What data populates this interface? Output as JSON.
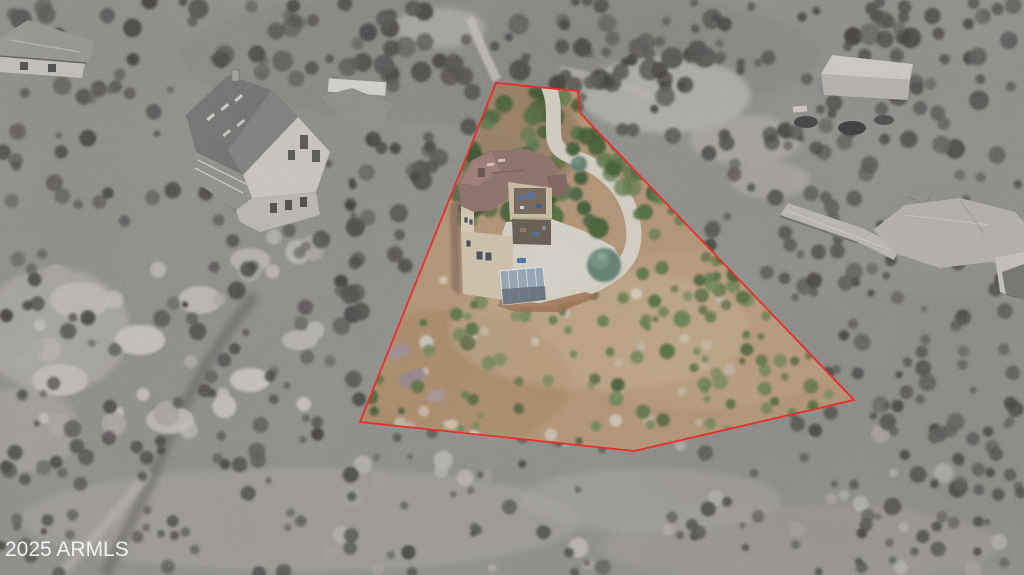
{
  "watermark": {
    "text": "2025 ARMLS"
  },
  "boundary": {
    "points": "496,83 578,91 580,113 854,400 634,451 360,422",
    "color": "#f01b15",
    "width": 2
  },
  "palette": {
    "gray_base": "#8d8b88",
    "lot_ground": "#b29170",
    "driveway": "#d6d1c6",
    "roof_main": "#8a6a64",
    "wall": "#cfc1a8",
    "spruce": "#5a7a6c",
    "tree_green": "#4a6737"
  },
  "seed": 20250101,
  "scatter": [
    {
      "target": "g-rocks",
      "x": 25,
      "y": 235,
      "w": 300,
      "h": 195,
      "count": 26,
      "rmin": 5,
      "rmax": 13,
      "colors": [
        "#b4b1ac",
        "#c1beb8",
        "#a8a5a0"
      ]
    },
    {
      "target": "g-rocks",
      "x": 300,
      "y": 430,
      "w": 724,
      "h": 140,
      "count": 34,
      "rmin": 4,
      "rmax": 10,
      "colors": [
        "#aeaba6",
        "#b8b5b0",
        "#a19e99"
      ]
    },
    {
      "target": "g-shrubs",
      "x": 0,
      "y": 0,
      "w": 1024,
      "h": 88,
      "count": 110,
      "rmin": 4,
      "rmax": 11,
      "colors": [
        "#504f4c",
        "#45443f",
        "#5a5955",
        "#3b3a37"
      ]
    },
    {
      "target": "g-shrubs",
      "x": 0,
      "y": 85,
      "w": 360,
      "h": 400,
      "count": 120,
      "rmin": 3,
      "rmax": 9,
      "colors": [
        "#504f4c",
        "#45443f",
        "#5c5b57",
        "#3b3a37"
      ]
    },
    {
      "target": "g-shrubs",
      "x": 350,
      "y": 60,
      "w": 130,
      "h": 260,
      "count": 45,
      "rmin": 5,
      "rmax": 10,
      "colors": [
        "#4a4945",
        "#3e3d39",
        "#555450"
      ]
    },
    {
      "target": "g-shrubs",
      "x": 560,
      "y": 0,
      "w": 464,
      "h": 150,
      "count": 70,
      "rmin": 4,
      "rmax": 10,
      "colors": [
        "#4c4b47",
        "#403f3b",
        "#575652"
      ]
    },
    {
      "target": "g-shrubs",
      "x": 845,
      "y": 150,
      "w": 179,
      "h": 420,
      "count": 75,
      "rmin": 3,
      "rmax": 9,
      "colors": [
        "#4e4d49",
        "#42413d",
        "#585753"
      ]
    },
    {
      "target": "g-shrubs",
      "x": 690,
      "y": 130,
      "w": 170,
      "h": 300,
      "count": 55,
      "rmin": 3,
      "rmax": 9,
      "colors": [
        "#4e4d49",
        "#42413d",
        "#565551"
      ]
    },
    {
      "target": "g-shrubs",
      "x": 0,
      "y": 430,
      "w": 1024,
      "h": 145,
      "count": 110,
      "rmin": 3,
      "rmax": 8,
      "colors": [
        "#504f4b",
        "#44433f",
        "#5a5955"
      ]
    },
    {
      "target": "c-rocks",
      "x": 390,
      "y": 270,
      "w": 340,
      "h": 165,
      "count": 30,
      "rmin": 3,
      "rmax": 7,
      "colors": [
        "#cfc7ba",
        "#c2b4a3",
        "#d6cfc2"
      ]
    },
    {
      "target": "c-shrubs",
      "x": 365,
      "y": 240,
      "w": 470,
      "h": 215,
      "count": 120,
      "rmin": 3,
      "rmax": 8,
      "colors": [
        "#4d6a39",
        "#5c7944",
        "#415830",
        "#6a8251"
      ]
    },
    {
      "target": "c-shrubs",
      "x": 640,
      "y": 200,
      "w": 200,
      "h": 120,
      "count": 26,
      "rmin": 4,
      "rmax": 9,
      "colors": [
        "#4d6a39",
        "#5c7944",
        "#415830"
      ]
    },
    {
      "target": "c-trees",
      "x": 450,
      "y": 85,
      "w": 115,
      "h": 135,
      "count": 42,
      "rmin": 6,
      "rmax": 12,
      "colors": [
        "#3d5a2e",
        "#4a6737",
        "#567444",
        "#324d26"
      ]
    },
    {
      "target": "c-trees",
      "x": 560,
      "y": 88,
      "w": 60,
      "h": 60,
      "count": 12,
      "rmin": 5,
      "rmax": 10,
      "colors": [
        "#3d5a2e",
        "#4a6737",
        "#324d26"
      ]
    },
    {
      "target": "c-trees2",
      "x": 598,
      "y": 110,
      "w": 105,
      "h": 125,
      "count": 26,
      "rmin": 5,
      "rmax": 11,
      "colors": [
        "#3d5a2e",
        "#4a6737",
        "#567444"
      ]
    },
    {
      "target": "c-trees2",
      "x": 690,
      "y": 215,
      "w": 120,
      "h": 95,
      "count": 16,
      "rmin": 4,
      "rmax": 9,
      "colors": [
        "#3d5a2e",
        "#4a6737",
        "#567444"
      ]
    }
  ]
}
